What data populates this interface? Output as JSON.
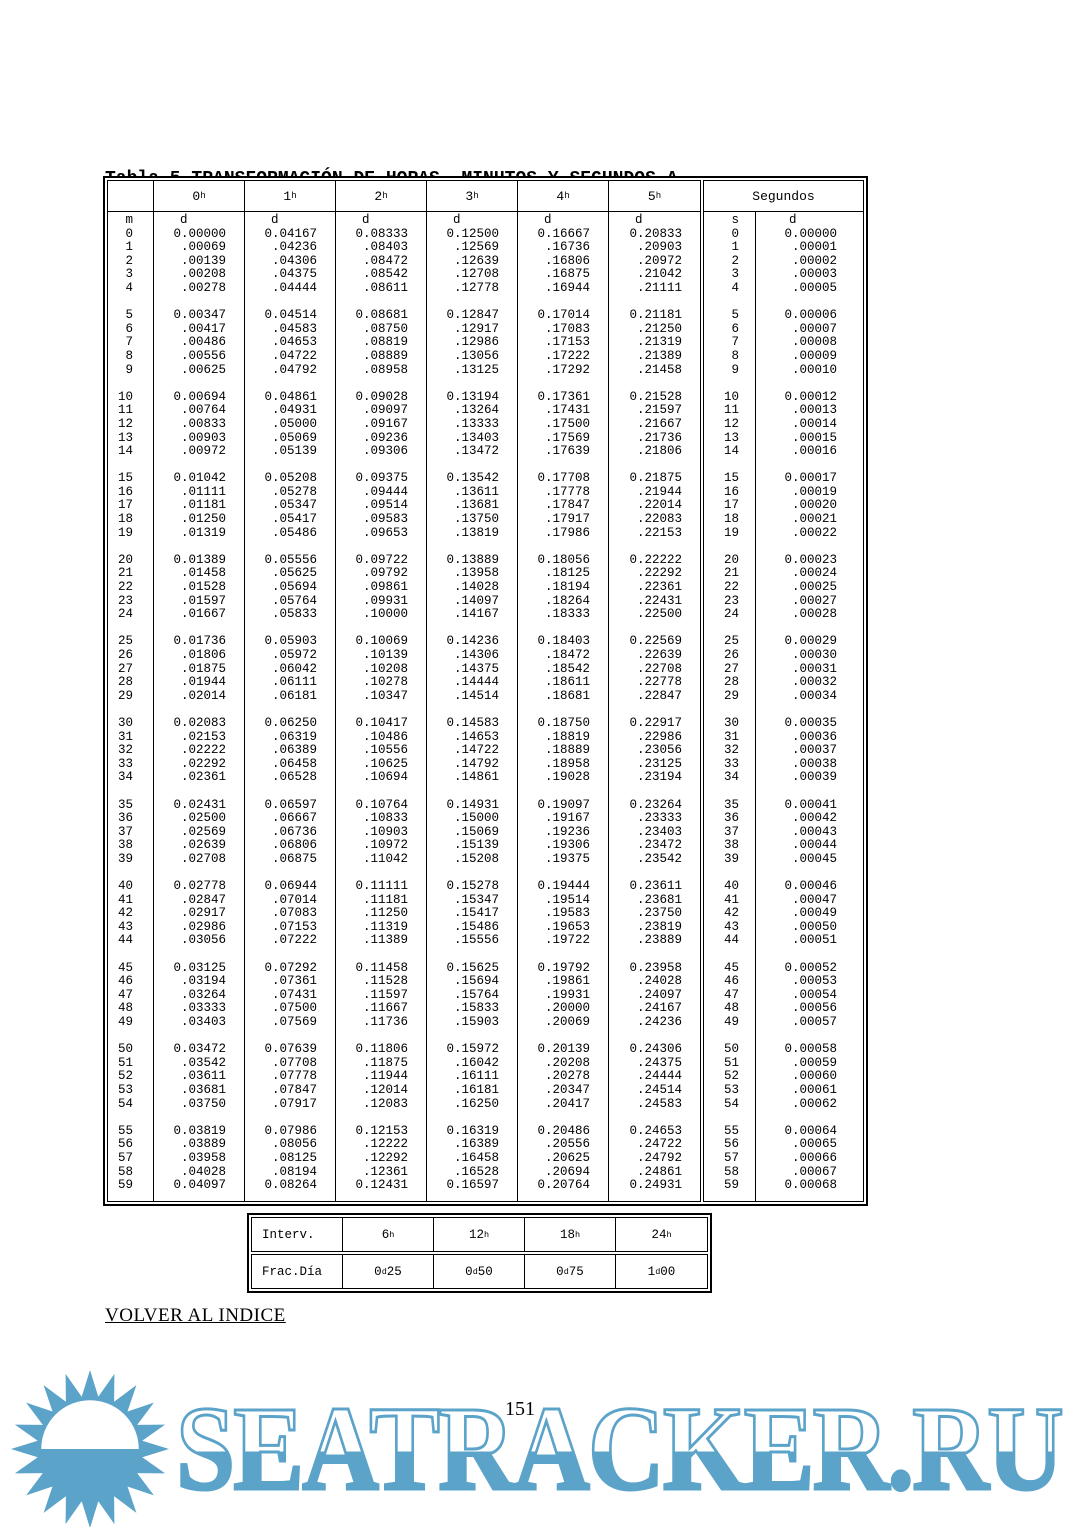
{
  "page": {
    "title_line1": "Tabla 5.TRANSFORMACIÓN DE HORAS, MINUTOS Y SEGUNDOS A",
    "title_line2": "FRACCIÓN DECIMAL DEL DÍA",
    "link_text": "VOLVER AL INDICE",
    "page_number": "151"
  },
  "watermark": {
    "text": "SEATRACKER.RU",
    "color": "#5CA3C9"
  },
  "table": {
    "headers": {
      "hours": [
        "0",
        "1",
        "2",
        "3",
        "4",
        "5"
      ],
      "hour_sup": "h",
      "segundos": "Segundos",
      "sub_m": "m",
      "sub_d": "d",
      "sub_s": "s"
    },
    "minutes_rows": [
      [
        "0",
        "0.00000",
        "0.04167",
        "0.08333",
        "0.12500",
        "0.16667",
        "0.20833"
      ],
      [
        "1",
        ".00069",
        ".04236",
        ".08403",
        ".12569",
        ".16736",
        ".20903"
      ],
      [
        "2",
        ".00139",
        ".04306",
        ".08472",
        ".12639",
        ".16806",
        ".20972"
      ],
      [
        "3",
        ".00208",
        ".04375",
        ".08542",
        ".12708",
        ".16875",
        ".21042"
      ],
      [
        "4",
        ".00278",
        ".04444",
        ".08611",
        ".12778",
        ".16944",
        ".21111"
      ],
      [
        "5",
        "0.00347",
        "0.04514",
        "0.08681",
        "0.12847",
        "0.17014",
        "0.21181"
      ],
      [
        "6",
        ".00417",
        ".04583",
        ".08750",
        ".12917",
        ".17083",
        ".21250"
      ],
      [
        "7",
        ".00486",
        ".04653",
        ".08819",
        ".12986",
        ".17153",
        ".21319"
      ],
      [
        "8",
        ".00556",
        ".04722",
        ".08889",
        ".13056",
        ".17222",
        ".21389"
      ],
      [
        "9",
        ".00625",
        ".04792",
        ".08958",
        ".13125",
        ".17292",
        ".21458"
      ],
      [
        "10",
        "0.00694",
        "0.04861",
        "0.09028",
        "0.13194",
        "0.17361",
        "0.21528"
      ],
      [
        "11",
        ".00764",
        ".04931",
        ".09097",
        ".13264",
        ".17431",
        ".21597"
      ],
      [
        "12",
        ".00833",
        ".05000",
        ".09167",
        ".13333",
        ".17500",
        ".21667"
      ],
      [
        "13",
        ".00903",
        ".05069",
        ".09236",
        ".13403",
        ".17569",
        ".21736"
      ],
      [
        "14",
        ".00972",
        ".05139",
        ".09306",
        ".13472",
        ".17639",
        ".21806"
      ],
      [
        "15",
        "0.01042",
        "0.05208",
        "0.09375",
        "0.13542",
        "0.17708",
        "0.21875"
      ],
      [
        "16",
        ".01111",
        ".05278",
        ".09444",
        ".13611",
        ".17778",
        ".21944"
      ],
      [
        "17",
        ".01181",
        ".05347",
        ".09514",
        ".13681",
        ".17847",
        ".22014"
      ],
      [
        "18",
        ".01250",
        ".05417",
        ".09583",
        ".13750",
        ".17917",
        ".22083"
      ],
      [
        "19",
        ".01319",
        ".05486",
        ".09653",
        ".13819",
        ".17986",
        ".22153"
      ],
      [
        "20",
        "0.01389",
        "0.05556",
        "0.09722",
        "0.13889",
        "0.18056",
        "0.22222"
      ],
      [
        "21",
        ".01458",
        ".05625",
        ".09792",
        ".13958",
        ".18125",
        ".22292"
      ],
      [
        "22",
        ".01528",
        ".05694",
        ".09861",
        ".14028",
        ".18194",
        ".22361"
      ],
      [
        "23",
        ".01597",
        ".05764",
        ".09931",
        ".14097",
        ".18264",
        ".22431"
      ],
      [
        "24",
        ".01667",
        ".05833",
        ".10000",
        ".14167",
        ".18333",
        ".22500"
      ],
      [
        "25",
        "0.01736",
        "0.05903",
        "0.10069",
        "0.14236",
        "0.18403",
        "0.22569"
      ],
      [
        "26",
        ".01806",
        ".05972",
        ".10139",
        ".14306",
        ".18472",
        ".22639"
      ],
      [
        "27",
        ".01875",
        ".06042",
        ".10208",
        ".14375",
        ".18542",
        ".22708"
      ],
      [
        "28",
        ".01944",
        ".06111",
        ".10278",
        ".14444",
        ".18611",
        ".22778"
      ],
      [
        "29",
        ".02014",
        ".06181",
        ".10347",
        ".14514",
        ".18681",
        ".22847"
      ],
      [
        "30",
        "0.02083",
        "0.06250",
        "0.10417",
        "0.14583",
        "0.18750",
        "0.22917"
      ],
      [
        "31",
        ".02153",
        ".06319",
        ".10486",
        ".14653",
        ".18819",
        ".22986"
      ],
      [
        "32",
        ".02222",
        ".06389",
        ".10556",
        ".14722",
        ".18889",
        ".23056"
      ],
      [
        "33",
        ".02292",
        ".06458",
        ".10625",
        ".14792",
        ".18958",
        ".23125"
      ],
      [
        "34",
        ".02361",
        ".06528",
        ".10694",
        ".14861",
        ".19028",
        ".23194"
      ],
      [
        "35",
        "0.02431",
        "0.06597",
        "0.10764",
        "0.14931",
        "0.19097",
        "0.23264"
      ],
      [
        "36",
        ".02500",
        ".06667",
        ".10833",
        ".15000",
        ".19167",
        ".23333"
      ],
      [
        "37",
        ".02569",
        ".06736",
        ".10903",
        ".15069",
        ".19236",
        ".23403"
      ],
      [
        "38",
        ".02639",
        ".06806",
        ".10972",
        ".15139",
        ".19306",
        ".23472"
      ],
      [
        "39",
        ".02708",
        ".06875",
        ".11042",
        ".15208",
        ".19375",
        ".23542"
      ],
      [
        "40",
        "0.02778",
        "0.06944",
        "0.11111",
        "0.15278",
        "0.19444",
        "0.23611"
      ],
      [
        "41",
        ".02847",
        ".07014",
        ".11181",
        ".15347",
        ".19514",
        ".23681"
      ],
      [
        "42",
        ".02917",
        ".07083",
        ".11250",
        ".15417",
        ".19583",
        ".23750"
      ],
      [
        "43",
        ".02986",
        ".07153",
        ".11319",
        ".15486",
        ".19653",
        ".23819"
      ],
      [
        "44",
        ".03056",
        ".07222",
        ".11389",
        ".15556",
        ".19722",
        ".23889"
      ],
      [
        "45",
        "0.03125",
        "0.07292",
        "0.11458",
        "0.15625",
        "0.19792",
        "0.23958"
      ],
      [
        "46",
        ".03194",
        ".07361",
        ".11528",
        ".15694",
        ".19861",
        ".24028"
      ],
      [
        "47",
        ".03264",
        ".07431",
        ".11597",
        ".15764",
        ".19931",
        ".24097"
      ],
      [
        "48",
        ".03333",
        ".07500",
        ".11667",
        ".15833",
        ".20000",
        ".24167"
      ],
      [
        "49",
        ".03403",
        ".07569",
        ".11736",
        ".15903",
        ".20069",
        ".24236"
      ],
      [
        "50",
        "0.03472",
        "0.07639",
        "0.11806",
        "0.15972",
        "0.20139",
        "0.24306"
      ],
      [
        "51",
        ".03542",
        ".07708",
        ".11875",
        ".16042",
        ".20208",
        ".24375"
      ],
      [
        "52",
        ".03611",
        ".07778",
        ".11944",
        ".16111",
        ".20278",
        ".24444"
      ],
      [
        "53",
        ".03681",
        ".07847",
        ".12014",
        ".16181",
        ".20347",
        ".24514"
      ],
      [
        "54",
        ".03750",
        ".07917",
        ".12083",
        ".16250",
        ".20417",
        ".24583"
      ],
      [
        "55",
        "0.03819",
        "0.07986",
        "0.12153",
        "0.16319",
        "0.20486",
        "0.24653"
      ],
      [
        "56",
        ".03889",
        ".08056",
        ".12222",
        ".16389",
        ".20556",
        ".24722"
      ],
      [
        "57",
        ".03958",
        ".08125",
        ".12292",
        ".16458",
        ".20625",
        ".24792"
      ],
      [
        "58",
        ".04028",
        ".08194",
        ".12361",
        ".16528",
        ".20694",
        ".24861"
      ],
      [
        "59",
        "0.04097",
        "0.08264",
        "0.12431",
        "0.16597",
        "0.20764",
        "0.24931"
      ]
    ],
    "seconds_rows": [
      [
        "0",
        "0.00000"
      ],
      [
        "1",
        ".00001"
      ],
      [
        "2",
        ".00002"
      ],
      [
        "3",
        ".00003"
      ],
      [
        "4",
        ".00005"
      ],
      [
        "5",
        "0.00006"
      ],
      [
        "6",
        ".00007"
      ],
      [
        "7",
        ".00008"
      ],
      [
        "8",
        ".00009"
      ],
      [
        "9",
        ".00010"
      ],
      [
        "10",
        "0.00012"
      ],
      [
        "11",
        ".00013"
      ],
      [
        "12",
        ".00014"
      ],
      [
        "13",
        ".00015"
      ],
      [
        "14",
        ".00016"
      ],
      [
        "15",
        "0.00017"
      ],
      [
        "16",
        ".00019"
      ],
      [
        "17",
        ".00020"
      ],
      [
        "18",
        ".00021"
      ],
      [
        "19",
        ".00022"
      ],
      [
        "20",
        "0.00023"
      ],
      [
        "21",
        ".00024"
      ],
      [
        "22",
        ".00025"
      ],
      [
        "23",
        ".00027"
      ],
      [
        "24",
        ".00028"
      ],
      [
        "25",
        "0.00029"
      ],
      [
        "26",
        ".00030"
      ],
      [
        "27",
        ".00031"
      ],
      [
        "28",
        ".00032"
      ],
      [
        "29",
        ".00034"
      ],
      [
        "30",
        "0.00035"
      ],
      [
        "31",
        ".00036"
      ],
      [
        "32",
        ".00037"
      ],
      [
        "33",
        ".00038"
      ],
      [
        "34",
        ".00039"
      ],
      [
        "35",
        "0.00041"
      ],
      [
        "36",
        ".00042"
      ],
      [
        "37",
        ".00043"
      ],
      [
        "38",
        ".00044"
      ],
      [
        "39",
        ".00045"
      ],
      [
        "40",
        "0.00046"
      ],
      [
        "41",
        ".00047"
      ],
      [
        "42",
        ".00049"
      ],
      [
        "43",
        ".00050"
      ],
      [
        "44",
        ".00051"
      ],
      [
        "45",
        "0.00052"
      ],
      [
        "46",
        ".00053"
      ],
      [
        "47",
        ".00054"
      ],
      [
        "48",
        ".00056"
      ],
      [
        "49",
        ".00057"
      ],
      [
        "50",
        "0.00058"
      ],
      [
        "51",
        ".00059"
      ],
      [
        "52",
        ".00060"
      ],
      [
        "53",
        ".00061"
      ],
      [
        "54",
        ".00062"
      ],
      [
        "55",
        "0.00064"
      ],
      [
        "56",
        ".00065"
      ],
      [
        "57",
        ".00066"
      ],
      [
        "58",
        ".00067"
      ],
      [
        "59",
        "0.00068"
      ]
    ]
  },
  "footer_table": {
    "rows": [
      {
        "label": "Interv.",
        "values": [
          {
            "n": "6",
            "sup": "h",
            "post": ""
          },
          {
            "n": "12",
            "sup": "h",
            "post": ""
          },
          {
            "n": "18",
            "sup": "h",
            "post": ""
          },
          {
            "n": "24",
            "sup": "h",
            "post": ""
          }
        ]
      },
      {
        "label": "Frac.Día",
        "values": [
          {
            "n": "0",
            "sup": "d",
            "post": "25"
          },
          {
            "n": "0",
            "sup": "d",
            "post": "50"
          },
          {
            "n": "0",
            "sup": "d",
            "post": "75"
          },
          {
            "n": "1",
            "sup": "d",
            "post": "00"
          }
        ]
      }
    ]
  }
}
